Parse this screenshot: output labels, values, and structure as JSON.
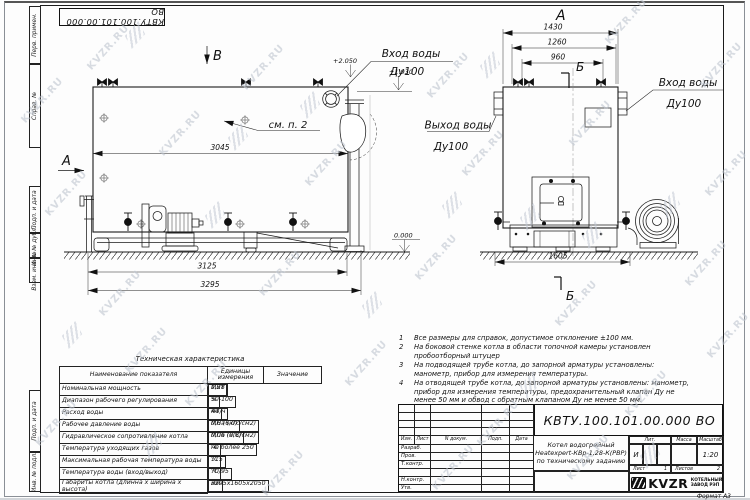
{
  "meta": {
    "watermark": "KVZR.RU",
    "accent_black": "#1a1a1a",
    "watermark_color": "#bfc6d0"
  },
  "stamp_top": "КВТУ.100.101.00.000 ВО",
  "margin_labels": [
    "Перв. примен.",
    "Справ. №",
    "Подп. и дата",
    "Инв. № дубл.",
    "Взам. инв. №",
    "Подп. и дата",
    "Инв. № подл."
  ],
  "views": {
    "side": {
      "view_label": "В",
      "section_label": "А",
      "see_note": "см. п. 2",
      "dim_width": "3045",
      "dim_frame": "3125",
      "dim_overall": "3295",
      "inlet_line1": "Вход воды",
      "inlet_line2": "Ду100",
      "elev_top": "+2.050",
      "elev_mid": "+1.930",
      "elev_zero": "0.000"
    },
    "front": {
      "view_label": "А",
      "section_label_top": "Б",
      "section_label_bottom": "Б",
      "dim_outer": "1430",
      "dim_mid": "1260",
      "dim_inner": "960",
      "dim_base": "1605",
      "outlet_line1": "Выход воды",
      "outlet_line2": "Ду100",
      "inlet_line1": "Вход воды",
      "inlet_line2": "Ду100"
    }
  },
  "tech_table": {
    "title": "Техническая характеристика",
    "headers": [
      "Наименование показателя",
      "Единицы измерения",
      "Значение"
    ],
    "rows": [
      [
        "Номинальная мощность",
        "МВт",
        "1,28"
      ],
      [
        "Диапазон рабочего регулирования",
        "%",
        "50-100"
      ],
      [
        "Расход воды",
        "м3/ч",
        "44"
      ],
      [
        "Рабочее давление воды",
        "МПа (кгс/см2)",
        "0,6 (6,0)"
      ],
      [
        "Гидравлическое сопротивление котла",
        "МПа (кгс/см2)",
        "0,06 (0,6)"
      ],
      [
        "Температура уходящих газов",
        "°С",
        "не более 250"
      ],
      [
        "Максимальная рабочая температура воды",
        "°С",
        "115"
      ],
      [
        "Температура воды (вход/выход)",
        "°С",
        "70/95"
      ],
      [
        "Габариты котла (длинна х ширина х высота)",
        "мм",
        "3295х1605х2050"
      ]
    ]
  },
  "notes": [
    {
      "n": "1",
      "text": "Все размеры для справок, допустимое отклонение ±100 мм."
    },
    {
      "n": "2",
      "text": "На боковой стенке котла в области топочной камеры установлен пробоотборный штуцер"
    },
    {
      "n": "3",
      "text": "На подводящей трубе котла, до запорной арматуры установлены: манометр, прибор для измерения температуры."
    },
    {
      "n": "4",
      "text": "На отводящей трубе котла, до запорной арматуры установлены: манометр, прибор для измерения температуры, предохранительный клапан Ду не менее 50 мм и обвод с обратным клапаном Ду не менее 50 мм."
    }
  ],
  "title_block": {
    "doc_number": "КВТУ.100.101.00.000  ВО",
    "cols": [
      "Изм.",
      "Лист",
      "N докум.",
      "Подп.",
      "Дата"
    ],
    "rows": [
      "Разраб.",
      "Пров.",
      "Т.контр.",
      "",
      "Н.контр.",
      "Утв."
    ],
    "title_line1": "Котел водогрейный",
    "title_line2": "Heatexpert-КВр-1,28-К(РВР)",
    "title_line3": "по техническому заданию",
    "lit_header": "Лит.",
    "lit_value": "И",
    "mass_header": "Масса",
    "scale_header": "Масштаб",
    "scale_value": "1:20",
    "sheet_label": "Лист",
    "sheet_value": "1",
    "sheets_label": "Листов",
    "sheets_value": "2",
    "company_logo": "KVZR",
    "company_name_1": "КОТЕЛЬНЫЙ",
    "company_name_2": "ЗАВОД РЭП",
    "format": "Формат  А3"
  }
}
